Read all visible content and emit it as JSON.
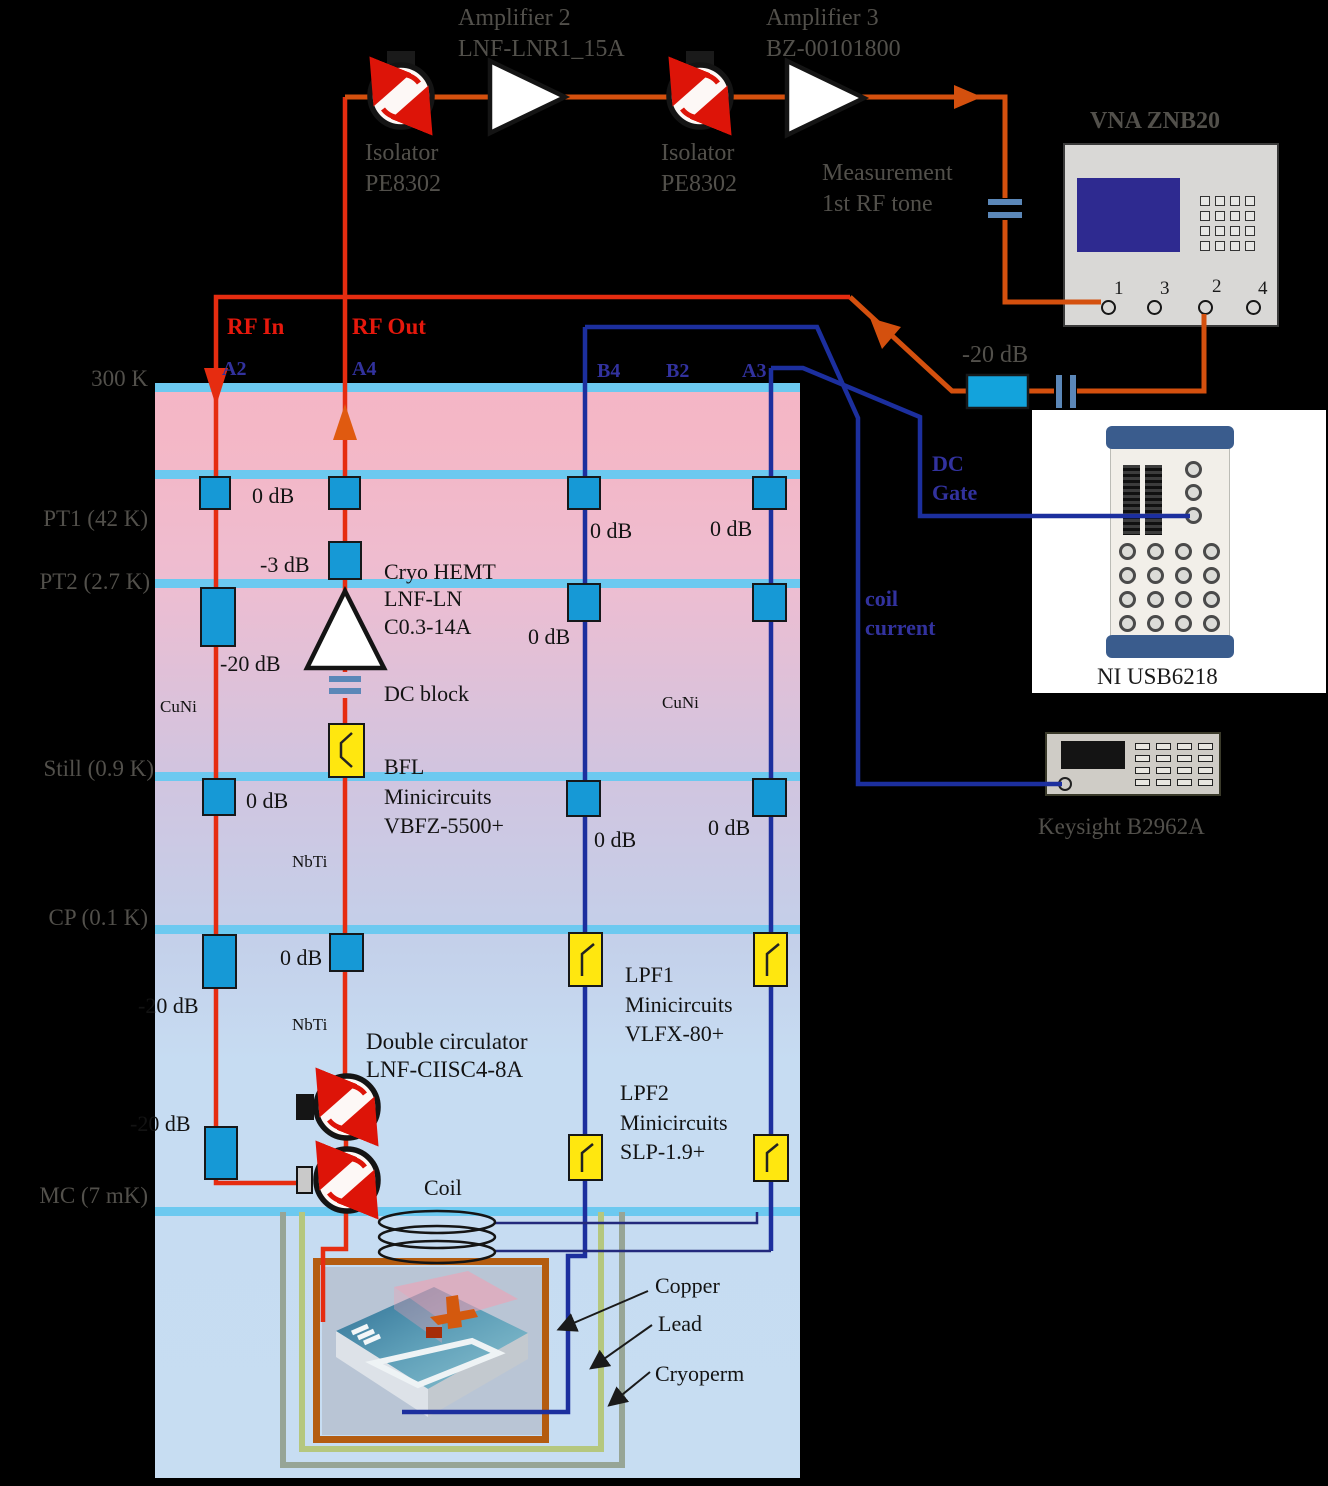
{
  "colors": {
    "rf_line_red": "#e62c10",
    "rf_line_orange": "#d4500e",
    "dc_line_navy": "#1c2f9e",
    "attenuator_blue": "#1699d6",
    "filter_yellow": "#ffe70f",
    "stage_bar_blue": "#6cc9f0",
    "copper_shield": "#b45c10",
    "lead_shield": "#b5c77e",
    "cryoperm_shield": "#97a596",
    "vna_screen": "#2e2a90"
  },
  "top_chain": {
    "isolator1": {
      "label": "Isolator",
      "model": "PE8302"
    },
    "amplifier2": {
      "label": "Amplifier 2",
      "model": "LNF-LNR1_15A"
    },
    "isolator2": {
      "label": "Isolator",
      "model": "PE8302"
    },
    "amplifier3": {
      "label": "Amplifier 3",
      "model": "BZ-00101800"
    },
    "measurement_note": {
      "line1": "Measurement",
      "line2": "1st RF tone"
    }
  },
  "vna": {
    "title": "VNA ZNB20",
    "port1": "1",
    "port3": "3",
    "port2": "2",
    "port4": "4"
  },
  "room_temp": {
    "output_attenuator": "-20 dB",
    "dc_gate": {
      "line1": "DC",
      "line2": "Gate"
    },
    "coil_current": {
      "line1": "coil",
      "line2": "current"
    }
  },
  "instruments": {
    "ni_daq": "NI USB6218",
    "source_meter": "Keysight  B2962A"
  },
  "rf_ports": {
    "rf_in": "RF In",
    "rf_out": "RF Out",
    "a2": "A2",
    "a4": "A4",
    "b4": "B4",
    "b2": "B2",
    "a3": "A3"
  },
  "stages": {
    "s300k": "300 K",
    "pt1": "PT1  (42 K)",
    "pt2": "PT2  (2.7 K)",
    "still": "Still  (0.9 K)",
    "cp": "CP  (0.1 K)",
    "mc": "MC (7 mK)"
  },
  "attenuators": {
    "pt1_pair": "0 dB",
    "b4_pt1": "0 dB",
    "a3_pt1": "0 dB",
    "a4_pt2": "-3 dB",
    "b4_pt2": "0 dB",
    "a2_pt2": "-20 dB",
    "a2_still": "0 dB",
    "b4_still": "0 dB",
    "a3_still": "0 dB",
    "a4_cp": "0 dB",
    "a2_cp": "-20 dB",
    "a2_mc": "-20 dB"
  },
  "wires": {
    "cuni_left": "CuNi",
    "cuni_right": "CuNi",
    "nbti_upper": "NbTi",
    "nbti_lower": "NbTi"
  },
  "components": {
    "hemt": {
      "line1": "Cryo HEMT",
      "line2": "LNF-LN",
      "line3": "C0.3-14A"
    },
    "dc_block": "DC block",
    "bfl": {
      "line1": "BFL",
      "line2": "Minicircuits",
      "line3": "VBFZ-5500+"
    },
    "lpf1": {
      "line1": "LPF1",
      "line2": "Minicircuits",
      "line3": "VLFX-80+"
    },
    "lpf2": {
      "line1": "LPF2",
      "line2": "Minicircuits",
      "line3": "SLP-1.9+"
    },
    "double_circulator": {
      "line1": "Double circulator",
      "line2": "LNF-CIISC4-8A"
    },
    "coil": "Coil"
  },
  "shields": {
    "copper": "Copper",
    "lead": "Lead",
    "cryoperm": "Cryoperm"
  }
}
